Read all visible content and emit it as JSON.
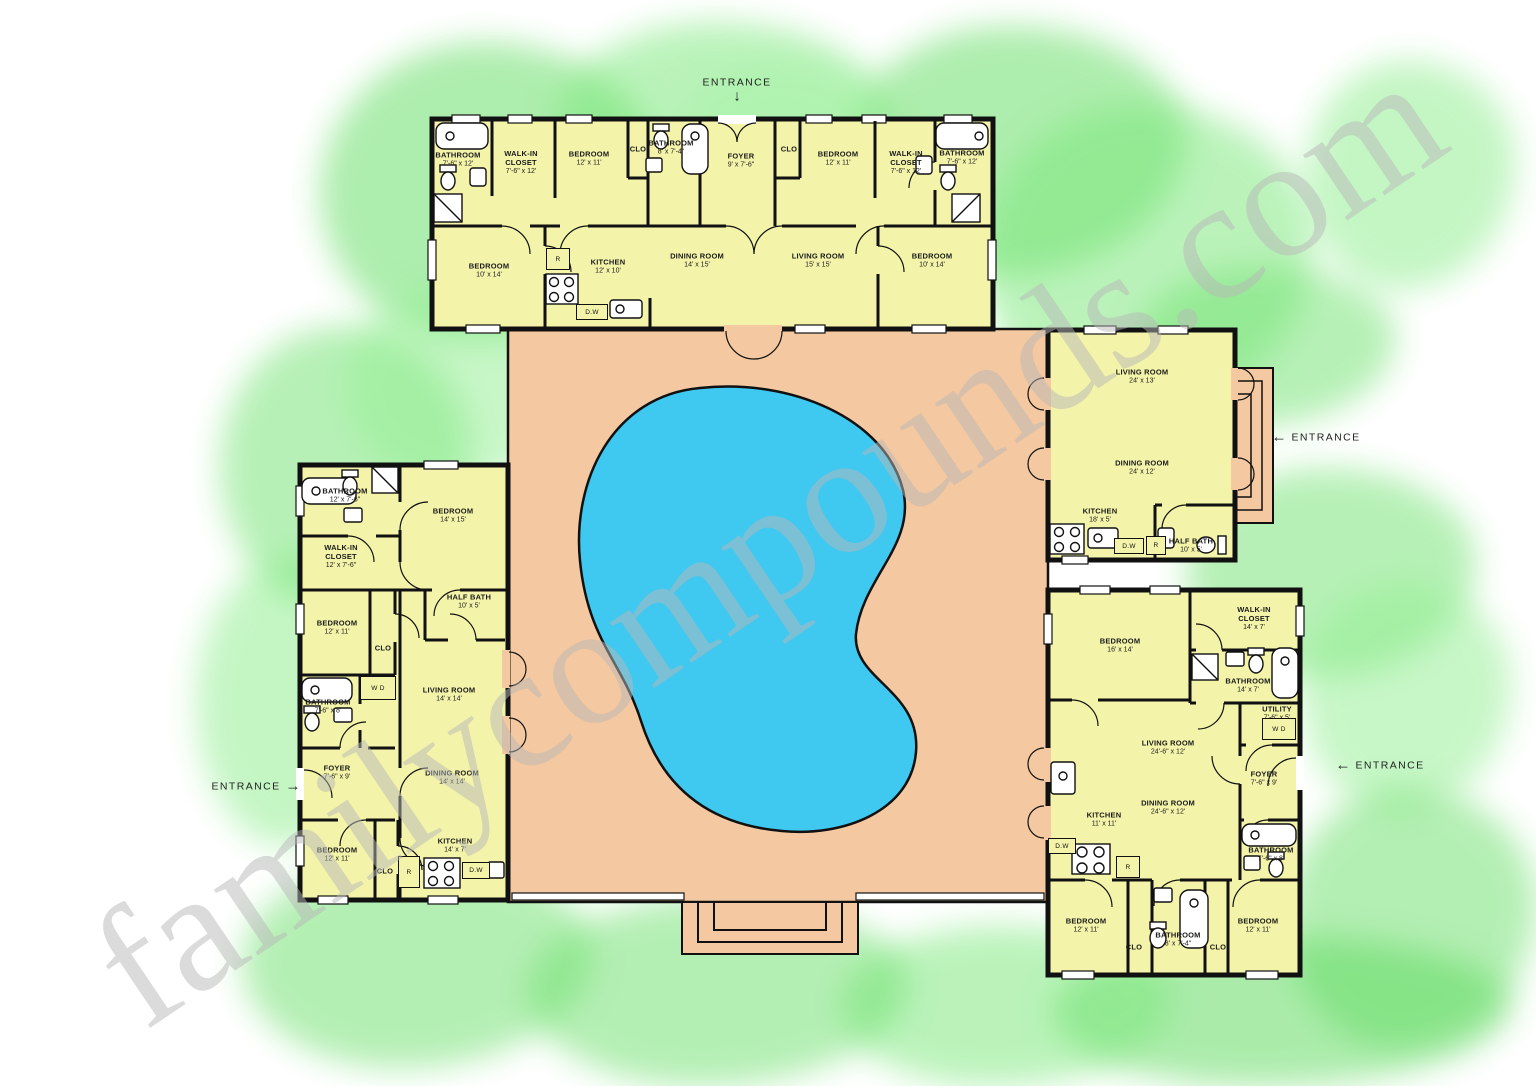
{
  "watermark": "familycompounds.com",
  "colors": {
    "room_fill": "#f3f3aa",
    "courtyard": "#f4c8a0",
    "pool": "#3fc8f0",
    "wall": "#111111",
    "landscape_green": "#6ede6e"
  },
  "entrances": [
    {
      "label": "ENTRANCE",
      "direction": "down",
      "x": 737,
      "y": 90
    },
    {
      "label": "ENTRANCE",
      "direction": "left",
      "x": 1316,
      "y": 437
    },
    {
      "label": "ENTRANCE",
      "direction": "left",
      "x": 1380,
      "y": 765
    },
    {
      "label": "ENTRANCE",
      "direction": "right",
      "x": 256,
      "y": 786
    }
  ],
  "houses": {
    "north": {
      "rooms": [
        {
          "name": "BATHROOM",
          "dim": "7'-6\" x 12'",
          "x": 458,
          "y": 160,
          "w": 54
        },
        {
          "name": "WALK-IN CLOSET",
          "dim": "7'-6\" x 12'",
          "x": 521,
          "y": 163,
          "w": 50
        },
        {
          "name": "BEDROOM",
          "dim": "12' x 11'",
          "x": 589,
          "y": 159,
          "w": 70
        },
        {
          "name": "CLO",
          "dim": "",
          "x": 638,
          "y": 150,
          "w": 30
        },
        {
          "name": "BATHROOM",
          "dim": "8' x 7'-4\"",
          "x": 671,
          "y": 148,
          "w": 46
        },
        {
          "name": "FOYER",
          "dim": "9' x 7'-6\"",
          "x": 741,
          "y": 161,
          "w": 60
        },
        {
          "name": "CLO",
          "dim": "",
          "x": 789,
          "y": 150,
          "w": 30
        },
        {
          "name": "BEDROOM",
          "dim": "12' x 11'",
          "x": 838,
          "y": 159,
          "w": 70
        },
        {
          "name": "WALK-IN CLOSET",
          "dim": "7'-6\" x 12'",
          "x": 906,
          "y": 163,
          "w": 50
        },
        {
          "name": "BATHROOM",
          "dim": "7'-6\" x 12'",
          "x": 962,
          "y": 158,
          "w": 54
        },
        {
          "name": "BEDROOM",
          "dim": "10' x 14'",
          "x": 489,
          "y": 271,
          "w": 70
        },
        {
          "name": "KITCHEN",
          "dim": "12' x 10'",
          "x": 608,
          "y": 267,
          "w": 70
        },
        {
          "name": "DINING ROOM",
          "dim": "14' x 15'",
          "x": 697,
          "y": 261,
          "w": 90
        },
        {
          "name": "LIVING ROOM",
          "dim": "15' x 15'",
          "x": 818,
          "y": 261,
          "w": 90
        },
        {
          "name": "BEDROOM",
          "dim": "10' x 14'",
          "x": 932,
          "y": 261,
          "w": 70
        }
      ]
    },
    "west": {
      "rooms": [
        {
          "name": "BATHROOM",
          "dim": "12' x 7'-6\"",
          "x": 345,
          "y": 496,
          "w": 56
        },
        {
          "name": "BEDROOM",
          "dim": "14' x 15'",
          "x": 453,
          "y": 516,
          "w": 70
        },
        {
          "name": "WALK-IN CLOSET",
          "dim": "12' x 7'-6\"",
          "x": 341,
          "y": 557,
          "w": 54
        },
        {
          "name": "BEDROOM",
          "dim": "12' x 11'",
          "x": 337,
          "y": 628,
          "w": 66
        },
        {
          "name": "CLO",
          "dim": "",
          "x": 383,
          "y": 649,
          "w": 30
        },
        {
          "name": "HALF BATH",
          "dim": "10' x 5'",
          "x": 469,
          "y": 602,
          "w": 64
        },
        {
          "name": "LIVING ROOM",
          "dim": "14' x 14'",
          "x": 449,
          "y": 695,
          "w": 80
        },
        {
          "name": "BATHROOM",
          "dim": "7'-6\" x 8'",
          "x": 328,
          "y": 707,
          "w": 52
        },
        {
          "name": "FOYER",
          "dim": "7'-6\" x 9'",
          "x": 337,
          "y": 773,
          "w": 56
        },
        {
          "name": "DINING ROOM",
          "dim": "14' x 14'",
          "x": 452,
          "y": 778,
          "w": 80
        },
        {
          "name": "BEDROOM",
          "dim": "12' x 11'",
          "x": 337,
          "y": 855,
          "w": 66
        },
        {
          "name": "CLO",
          "dim": "",
          "x": 385,
          "y": 872,
          "w": 30
        },
        {
          "name": "KITCHEN",
          "dim": "14' x 7'",
          "x": 455,
          "y": 846,
          "w": 64
        }
      ]
    },
    "east": {
      "rooms": [
        {
          "name": "LIVING ROOM",
          "dim": "24' x 13'",
          "x": 1142,
          "y": 377,
          "w": 90
        },
        {
          "name": "DINING ROOM",
          "dim": "24' x 12'",
          "x": 1142,
          "y": 468,
          "w": 90
        },
        {
          "name": "KITCHEN",
          "dim": "18' x 5'",
          "x": 1100,
          "y": 516,
          "w": 64
        },
        {
          "name": "HALF BATH",
          "dim": "10' x 5'",
          "x": 1191,
          "y": 546,
          "w": 64
        }
      ]
    },
    "southeast": {
      "rooms": [
        {
          "name": "BEDROOM",
          "dim": "16' x 14'",
          "x": 1120,
          "y": 646,
          "w": 70
        },
        {
          "name": "WALK-IN CLOSET",
          "dim": "14' x 7'",
          "x": 1254,
          "y": 619,
          "w": 56
        },
        {
          "name": "BATHROOM",
          "dim": "14' x 7'",
          "x": 1248,
          "y": 686,
          "w": 60
        },
        {
          "name": "UTILITY",
          "dim": "7'-6\" x 5'",
          "x": 1277,
          "y": 714,
          "w": 50
        },
        {
          "name": "LIVING ROOM",
          "dim": "24'-6\" x 12'",
          "x": 1168,
          "y": 748,
          "w": 90
        },
        {
          "name": "FOYER",
          "dim": "7'-6\" x 9'",
          "x": 1264,
          "y": 779,
          "w": 56
        },
        {
          "name": "DINING ROOM",
          "dim": "24'-6\" x 12'",
          "x": 1168,
          "y": 808,
          "w": 90
        },
        {
          "name": "KITCHEN",
          "dim": "11' x 11'",
          "x": 1104,
          "y": 820,
          "w": 60
        },
        {
          "name": "BATHROOM",
          "dim": "7'-6\" x 8'",
          "x": 1271,
          "y": 855,
          "w": 54
        },
        {
          "name": "BEDROOM",
          "dim": "12' x 11'",
          "x": 1086,
          "y": 926,
          "w": 66
        },
        {
          "name": "CLO",
          "dim": "",
          "x": 1134,
          "y": 948,
          "w": 30
        },
        {
          "name": "BATHROOM",
          "dim": "8' x 7'-4\"",
          "x": 1178,
          "y": 940,
          "w": 52
        },
        {
          "name": "CLO",
          "dim": "",
          "x": 1218,
          "y": 948,
          "w": 30
        },
        {
          "name": "BEDROOM",
          "dim": "12' x 11'",
          "x": 1258,
          "y": 926,
          "w": 66
        }
      ]
    }
  },
  "appliances": [
    {
      "label": "R",
      "x": 546,
      "y": 248,
      "w": 24,
      "h": 22
    },
    {
      "label": "D.W",
      "x": 576,
      "y": 304,
      "w": 32,
      "h": 16
    },
    {
      "label": "D.W",
      "x": 1114,
      "y": 538,
      "w": 30,
      "h": 16
    },
    {
      "label": "R",
      "x": 1146,
      "y": 536,
      "w": 20,
      "h": 19
    },
    {
      "label": "W D",
      "x": 360,
      "y": 676,
      "w": 36,
      "h": 24
    },
    {
      "label": "R",
      "x": 398,
      "y": 856,
      "w": 22,
      "h": 32
    },
    {
      "label": "D.W",
      "x": 462,
      "y": 862,
      "w": 28,
      "h": 17
    },
    {
      "label": "W D",
      "x": 1262,
      "y": 718,
      "w": 34,
      "h": 22
    },
    {
      "label": "D.W",
      "x": 1048,
      "y": 838,
      "w": 28,
      "h": 16
    },
    {
      "label": "R",
      "x": 1116,
      "y": 856,
      "w": 24,
      "h": 22
    }
  ]
}
